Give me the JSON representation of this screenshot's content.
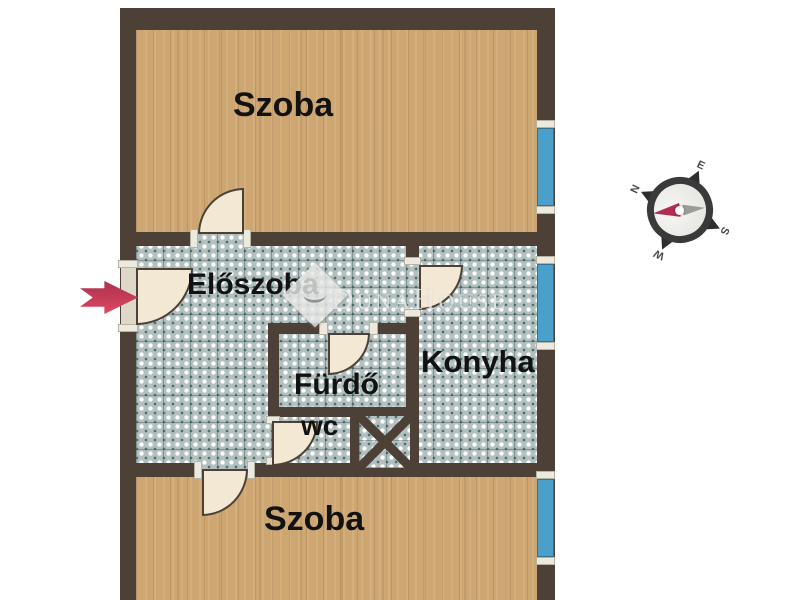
{
  "rooms": {
    "szoba_top": "Szoba",
    "eloszoba": "Előszoba",
    "konyha": "Konyha",
    "furdo": "Fürdő",
    "wc": "wc",
    "szoba_bottom": "Szoba"
  },
  "watermark": {
    "text": "DunaHouse"
  },
  "compass": {
    "n": "N",
    "e": "E",
    "s": "S",
    "w": "W"
  },
  "colors": {
    "wall": "#4C4037",
    "wood": "#CDA671",
    "tile": "#B2C1BF",
    "window": "#4AA0CB",
    "door": "#F2E8D3",
    "arrow": "#C9345A",
    "needle_red": "#B22C50",
    "needle_gray": "#9B9B98"
  }
}
